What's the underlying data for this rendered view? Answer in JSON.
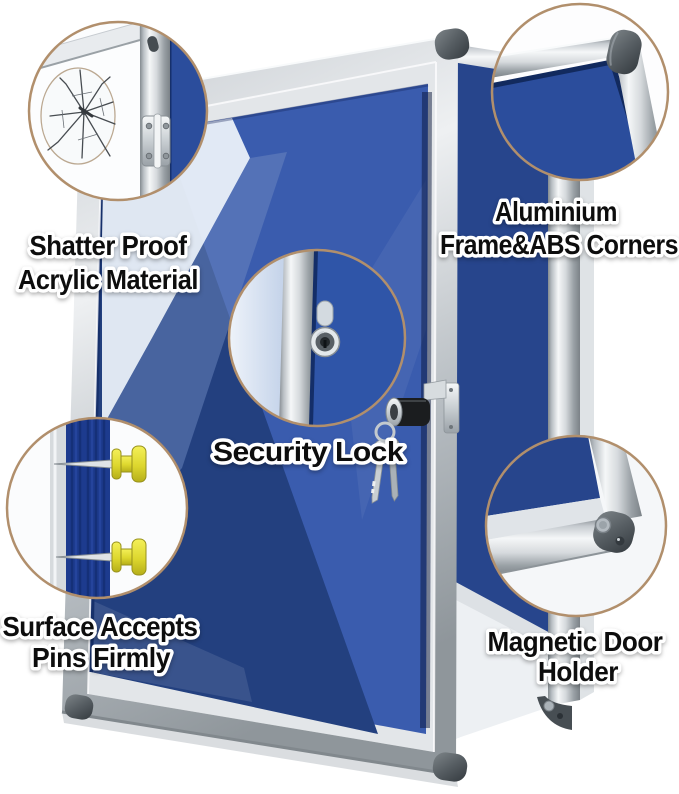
{
  "features": [
    {
      "name": "shatter-proof-acrylic",
      "label_line1": "Shatter Proof",
      "label_line2": "Acrylic Material"
    },
    {
      "name": "aluminium-frame-abs-corners",
      "label_line1": "Aluminium",
      "label_line2": "Frame&ABS Corners"
    },
    {
      "name": "security-lock",
      "label_line1": "Security Lock"
    },
    {
      "name": "pin-surface",
      "label_line1": "Surface Accepts",
      "label_line2": "Pins Firmly"
    },
    {
      "name": "magnetic-door-holder",
      "label_line1": "Magnetic Door",
      "label_line2": "Holder"
    }
  ],
  "colors": {
    "background": "#ffffff",
    "felt_bright": "#3a5cae",
    "felt_dark": "#23407f",
    "board_felt": "#2b4d9c",
    "cabinet_felt": "#27458c",
    "frame_silver": "#c3c8cc",
    "mat_border": "#e3e6e9",
    "corner_cap": "#454c51",
    "callout_ring": "#b18f6c",
    "pushpin_yellow": "#e9e43c",
    "text": "#0d0d0d"
  }
}
